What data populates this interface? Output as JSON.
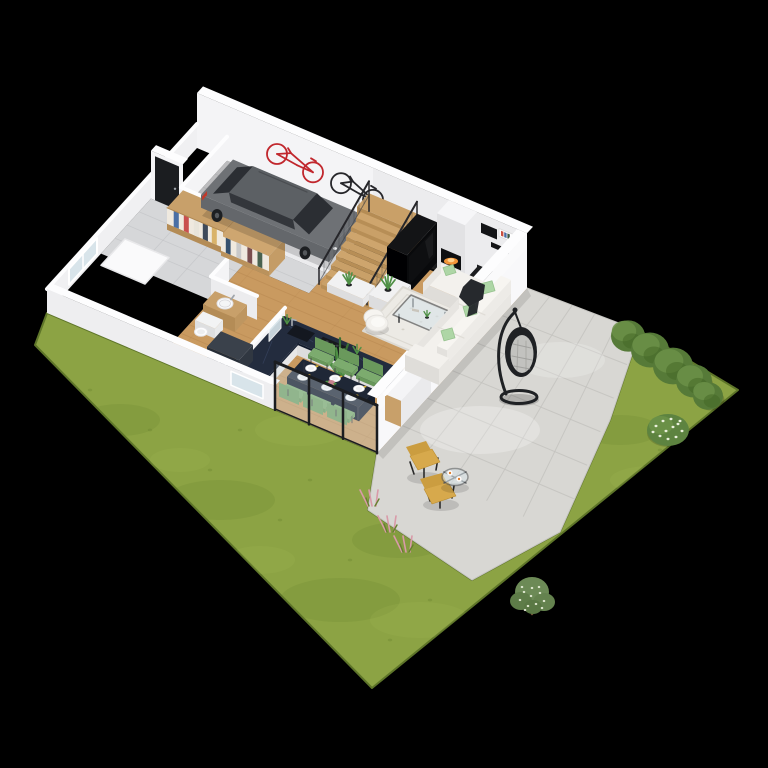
{
  "meta": {
    "description": "Isometric 3D cutaway floor plan render of a single-family house ground floor with garage, open living area and garden",
    "width": 768,
    "height": 768
  },
  "palette": {
    "bg": "#000000",
    "grass": "#8CA344",
    "grassDark": "#66802F",
    "grassLight": "#A6BC58",
    "grassEdge": "#5E7529",
    "patio": "#D8D7D3",
    "patioLine": "#C3C2BE",
    "wallFace": "#F4F4F6",
    "wallBright": "#F8F8FA",
    "wallShade": "#E9E9EC",
    "wallTop": "#FDFDFE",
    "woodFloor": "#C99A60",
    "woodLine": "#B5854E",
    "stairWood": "#C9A068",
    "concrete": "#BCBCBE",
    "tileHall": "#D6D7D9",
    "tileBath": "#454B55",
    "counterNavy": "#232C3E",
    "counterVein": "#50608A",
    "cabinetWhite": "#F1F1F2",
    "cabinetWood": "#C8A06A",
    "tableNavy": "#1F2736",
    "chairGreen": "#7CAB6E",
    "plateWhite": "#FFFFFF",
    "gold": "#D4AF37",
    "centerpiecePink": "#C9838F",
    "sofaWhite": "#F3F1ED",
    "pillowGreen": "#AED6A6",
    "throwDark": "#26292D",
    "rug": "#ECEAE5",
    "tvBlack": "#131416",
    "screenDark": "#0E0F11",
    "fireWhite": "#F6F6F8",
    "fireGlow": "#FF9D3C",
    "fireBright": "#FFD28E",
    "hearthDark": "#1C1D1F",
    "plantGreen": "#4E8F45",
    "plantDark": "#3A6F33",
    "potBlack": "#222426",
    "carBody": "#6E7175",
    "carRoof": "#5C6064",
    "carGlass": "#2B2E33",
    "wheelDark": "#1D1F22",
    "tailRed": "#C0392B",
    "bikeRed": "#C1272D",
    "bikeBlack": "#26262A",
    "eggFrame": "#1F2124",
    "eggCushion": "#C2C2BF",
    "chairYellow": "#D7A94C",
    "frameBlack": "#2A2A2A",
    "glass": "#D8E4EA",
    "doorBlack": "#1B1D20",
    "hedge": "#567A38",
    "hedgeLight": "#6B9148",
    "blossom": "#EAF0DC",
    "treeGreen": "#6C8A56",
    "trunkBrown": "#6B5334",
    "flowerPink": "#D99AA8",
    "sinkWhite": "#FAFAFB",
    "washerDark": "#3A414B",
    "matWhite": "#FAFAFB"
  },
  "scene": {
    "objects": [
      {
        "id": "lawn",
        "label": "garden lawn",
        "color": "grass"
      },
      {
        "id": "patio",
        "label": "stone patio terrace",
        "color": "patio"
      },
      {
        "id": "pink-flowers",
        "label": "pink ornamental grasses",
        "color": "flowerPink"
      },
      {
        "id": "hedge-bushes",
        "label": "hedge of five bushes",
        "color": "hedge"
      },
      {
        "id": "flowering-bush",
        "label": "white flowering bush",
        "color": "hedgeLight"
      },
      {
        "id": "garden-tree",
        "label": "small flowering tree",
        "color": "treeGreen"
      },
      {
        "id": "hanging-egg-chair",
        "label": "hanging egg chair",
        "color": "eggFrame"
      },
      {
        "id": "patio-lounge-chairs",
        "label": "two yellow lounge chairs",
        "color": "chairYellow"
      },
      {
        "id": "patio-side-table",
        "label": "round glass side table with two cups",
        "color": "glass"
      },
      {
        "id": "garage-floor",
        "label": "garage concrete floor",
        "color": "concrete"
      },
      {
        "id": "hall-floor",
        "label": "entry hall tiled floor",
        "color": "tileHall"
      },
      {
        "id": "bathroom-floor",
        "label": "bathroom dark tile floor",
        "color": "tileBath"
      },
      {
        "id": "wood-floor",
        "label": "oak plank floor of open living area",
        "color": "woodFloor"
      },
      {
        "id": "back-wall",
        "label": "tall back wall",
        "color": "wallFace"
      },
      {
        "id": "left-wall",
        "label": "left exterior wall with window",
        "color": "wallFace"
      },
      {
        "id": "entry-door-wall",
        "label": "entry wall with black front door",
        "color": "doorBlack"
      },
      {
        "id": "interior-walls",
        "label": "interior partition walls",
        "color": "wallFace"
      },
      {
        "id": "wall-bikes",
        "label": "red and black bicycles hung on garage wall",
        "color": "bikeRed"
      },
      {
        "id": "wardrobes",
        "label": "wooden wardrobes with clothes",
        "color": "cabinetWood"
      },
      {
        "id": "car",
        "label": "grey estate car in garage",
        "color": "carBody"
      },
      {
        "id": "fireplace",
        "label": "fireplace with burning fire",
        "color": "fireWhite"
      },
      {
        "id": "wall-shelves",
        "label": "black and white wall shelves with books",
        "color": "tvBlack"
      },
      {
        "id": "staircase",
        "label": "wooden staircase",
        "color": "stairWood"
      },
      {
        "id": "stair-railings",
        "label": "black mesh stair railings",
        "color": "bikeBlack"
      },
      {
        "id": "understair-cabinet",
        "label": "white cabinet with plant at stair foot",
        "color": "cabinetWhite"
      },
      {
        "id": "tv-unit",
        "label": "black media wall and TV cabinet",
        "color": "tvBlack"
      },
      {
        "id": "kitchen-counters",
        "label": "kitchen with navy marble counters and island",
        "color": "counterNavy"
      },
      {
        "id": "big-plant",
        "label": "large potted palm plant",
        "color": "plantGreen"
      },
      {
        "id": "dining-set",
        "label": "navy dining table with six green chairs and place settings",
        "color": "tableNavy"
      },
      {
        "id": "right-wall",
        "label": "tall right exterior wall",
        "color": "wallBright"
      },
      {
        "id": "patio-half-wall",
        "label": "low wall with wood panel beside sofa",
        "color": "cabinetWood"
      },
      {
        "id": "area-rug",
        "label": "light area rug",
        "color": "rug"
      },
      {
        "id": "coffee-table",
        "label": "glass coffee table",
        "color": "glass"
      },
      {
        "id": "sofa",
        "label": "white corner sofa with green pillows and dark throw",
        "color": "sofaWhite"
      },
      {
        "id": "armchair",
        "label": "white armchair",
        "color": "sofaWhite"
      },
      {
        "id": "bathroom-fixtures",
        "label": "vanity with round sink, toilet and washing machine",
        "color": "sinkWhite"
      },
      {
        "id": "entry-mat",
        "label": "white entry mat",
        "color": "matWhite"
      },
      {
        "id": "front-wall",
        "label": "cut front wall with kitchen window",
        "color": "wallFace"
      },
      {
        "id": "sliding-glass-door",
        "label": "sliding glass patio door",
        "color": "doorBlack"
      }
    ]
  }
}
